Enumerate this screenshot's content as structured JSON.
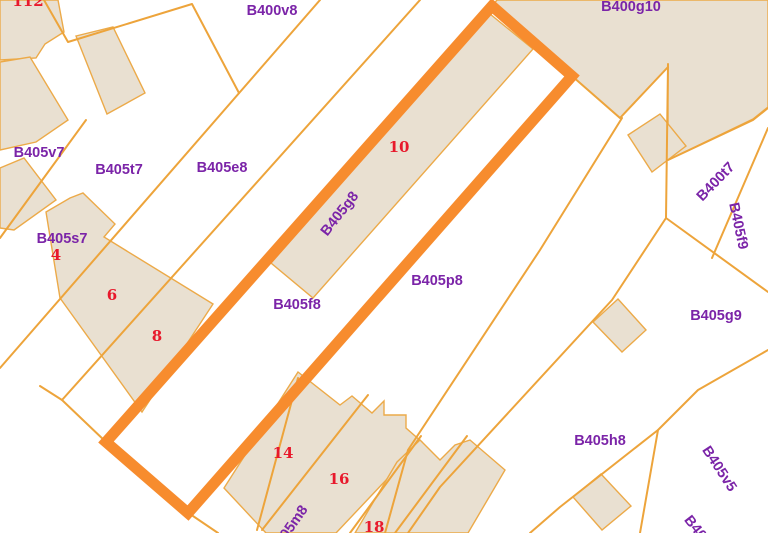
{
  "map": {
    "type": "cadastral-parcel-map",
    "colors": {
      "background": "#ffffff",
      "boundary_line": "#eda43b",
      "building_fill": "#e9e0d1",
      "building_stroke": "#ecaa49",
      "highlight_stroke": "#f78c2e",
      "parcel_label": "#7b24a8",
      "house_number": "#e8192c"
    },
    "selected_parcel": {
      "label": "B405f8",
      "outline": [
        [
          492,
          6
        ],
        [
          572,
          76
        ],
        [
          188,
          513
        ],
        [
          106,
          442
        ]
      ],
      "stroke_width": 11
    },
    "parcel_labels": [
      {
        "text": "B400v8",
        "x": 272,
        "y": 11,
        "rot": 0
      },
      {
        "text": "B400g10",
        "x": 631,
        "y": 7,
        "rot": 0
      },
      {
        "text": "B405v7",
        "x": 39,
        "y": 153,
        "rot": 0
      },
      {
        "text": "B405t7",
        "x": 119,
        "y": 170,
        "rot": 0
      },
      {
        "text": "B405e8",
        "x": 222,
        "y": 168,
        "rot": 0
      },
      {
        "text": "B405s7",
        "x": 62,
        "y": 239,
        "rot": 0
      },
      {
        "text": "B405f8",
        "x": 297,
        "y": 305,
        "rot": 0
      },
      {
        "text": "B405g8",
        "x": 340,
        "y": 214,
        "rot": -52
      },
      {
        "text": "B405p8",
        "x": 437,
        "y": 281,
        "rot": 0
      },
      {
        "text": "B400t7",
        "x": 716,
        "y": 182,
        "rot": -46
      },
      {
        "text": "B405f9",
        "x": 738,
        "y": 226,
        "rot": 78
      },
      {
        "text": "B405g9",
        "x": 716,
        "y": 316,
        "rot": 0
      },
      {
        "text": "B405h8",
        "x": 600,
        "y": 441,
        "rot": 0
      },
      {
        "text": "B405v5",
        "x": 719,
        "y": 469,
        "rot": 57
      },
      {
        "text": "B405m8",
        "x": 289,
        "y": 530,
        "rot": -55
      },
      {
        "text": "B40",
        "x": 695,
        "y": 528,
        "rot": 52
      }
    ],
    "house_numbers": [
      {
        "text": "112",
        "x": 28,
        "y": 1
      },
      {
        "text": "4",
        "x": 56,
        "y": 255
      },
      {
        "text": "6",
        "x": 112,
        "y": 295
      },
      {
        "text": "8",
        "x": 157,
        "y": 336
      },
      {
        "text": "10",
        "x": 399,
        "y": 147
      },
      {
        "text": "14",
        "x": 283,
        "y": 453
      },
      {
        "text": "16",
        "x": 339,
        "y": 479
      },
      {
        "text": "18",
        "x": 374,
        "y": 527
      }
    ],
    "boundaries": [
      [
        [
          44,
          0
        ],
        [
          68,
          42
        ],
        [
          192,
          4
        ],
        [
          239,
          93
        ]
      ],
      [
        [
          320,
          0
        ],
        [
          0,
          368
        ]
      ],
      [
        [
          420,
          0
        ],
        [
          62,
          400
        ]
      ],
      [
        [
          86,
          120
        ],
        [
          0,
          238
        ]
      ],
      [
        [
          40,
          386
        ],
        [
          62,
          400
        ],
        [
          106,
          442
        ],
        [
          190,
          514
        ],
        [
          218,
          533
        ]
      ],
      [
        [
          298,
          378
        ],
        [
          257,
          530
        ]
      ],
      [
        [
          368,
          395
        ],
        [
          262,
          530
        ]
      ],
      [
        [
          421,
          436
        ],
        [
          350,
          533
        ]
      ],
      [
        [
          467,
          436
        ],
        [
          395,
          533
        ]
      ],
      [
        [
          572,
          76
        ],
        [
          620,
          118
        ],
        [
          668,
          67
        ]
      ],
      [
        [
          668,
          64
        ],
        [
          666,
          218
        ],
        [
          612,
          300
        ],
        [
          440,
          487
        ],
        [
          408,
          533
        ]
      ],
      [
        [
          666,
          218
        ],
        [
          768,
          292
        ]
      ],
      [
        [
          622,
          118
        ],
        [
          540,
          250
        ],
        [
          408,
          450
        ],
        [
          385,
          533
        ]
      ],
      [
        [
          768,
          108
        ],
        [
          753,
          120
        ],
        [
          668,
          160
        ]
      ],
      [
        [
          768,
          128
        ],
        [
          712,
          258
        ]
      ],
      [
        [
          768,
          350
        ],
        [
          698,
          390
        ],
        [
          658,
          430
        ],
        [
          560,
          507
        ],
        [
          530,
          533
        ]
      ],
      [
        [
          658,
          430
        ],
        [
          640,
          533
        ]
      ]
    ],
    "buildings": [
      [
        [
          0,
          0
        ],
        [
          58,
          0
        ],
        [
          64,
          32
        ],
        [
          45,
          44
        ],
        [
          36,
          58
        ],
        [
          0,
          60
        ]
      ],
      [
        [
          76,
          36
        ],
        [
          113,
          27
        ],
        [
          145,
          93
        ],
        [
          107,
          114
        ]
      ],
      [
        [
          0,
          62
        ],
        [
          30,
          57
        ],
        [
          68,
          120
        ],
        [
          36,
          142
        ],
        [
          0,
          150
        ]
      ],
      [
        [
          0,
          168
        ],
        [
          24,
          158
        ],
        [
          56,
          200
        ],
        [
          14,
          230
        ],
        [
          0,
          228
        ]
      ],
      [
        [
          46,
          212
        ],
        [
          70,
          198
        ],
        [
          83,
          193
        ],
        [
          115,
          224
        ],
        [
          104,
          237
        ],
        [
          213,
          304
        ],
        [
          142,
          412
        ],
        [
          60,
          298
        ]
      ],
      [
        [
          490,
          14
        ],
        [
          533,
          49
        ],
        [
          313,
          298
        ],
        [
          271,
          263
        ]
      ],
      [
        [
          497,
          0
        ],
        [
          768,
          0
        ],
        [
          768,
          107
        ],
        [
          753,
          119
        ],
        [
          668,
          160
        ],
        [
          668,
          67
        ],
        [
          620,
          118
        ],
        [
          572,
          76
        ],
        [
          492,
          6
        ]
      ],
      [
        [
          628,
          135
        ],
        [
          660,
          114
        ],
        [
          686,
          146
        ],
        [
          652,
          172
        ]
      ],
      [
        [
          593,
          322
        ],
        [
          618,
          299
        ],
        [
          646,
          330
        ],
        [
          622,
          352
        ]
      ],
      [
        [
          573,
          497
        ],
        [
          601,
          474
        ],
        [
          631,
          506
        ],
        [
          602,
          530
        ]
      ],
      [
        [
          298,
          372
        ],
        [
          340,
          405
        ],
        [
          352,
          396
        ],
        [
          372,
          413
        ],
        [
          384,
          401
        ],
        [
          384,
          415
        ],
        [
          406,
          415
        ],
        [
          406,
          428
        ],
        [
          422,
          442
        ],
        [
          336,
          533
        ],
        [
          266,
          533
        ],
        [
          224,
          488
        ]
      ],
      [
        [
          397,
          462
        ],
        [
          420,
          440
        ],
        [
          440,
          460
        ],
        [
          455,
          445
        ],
        [
          470,
          440
        ],
        [
          505,
          470
        ],
        [
          468,
          533
        ],
        [
          355,
          533
        ]
      ]
    ],
    "label_font_size": 14.5,
    "number_font_size": 15
  }
}
